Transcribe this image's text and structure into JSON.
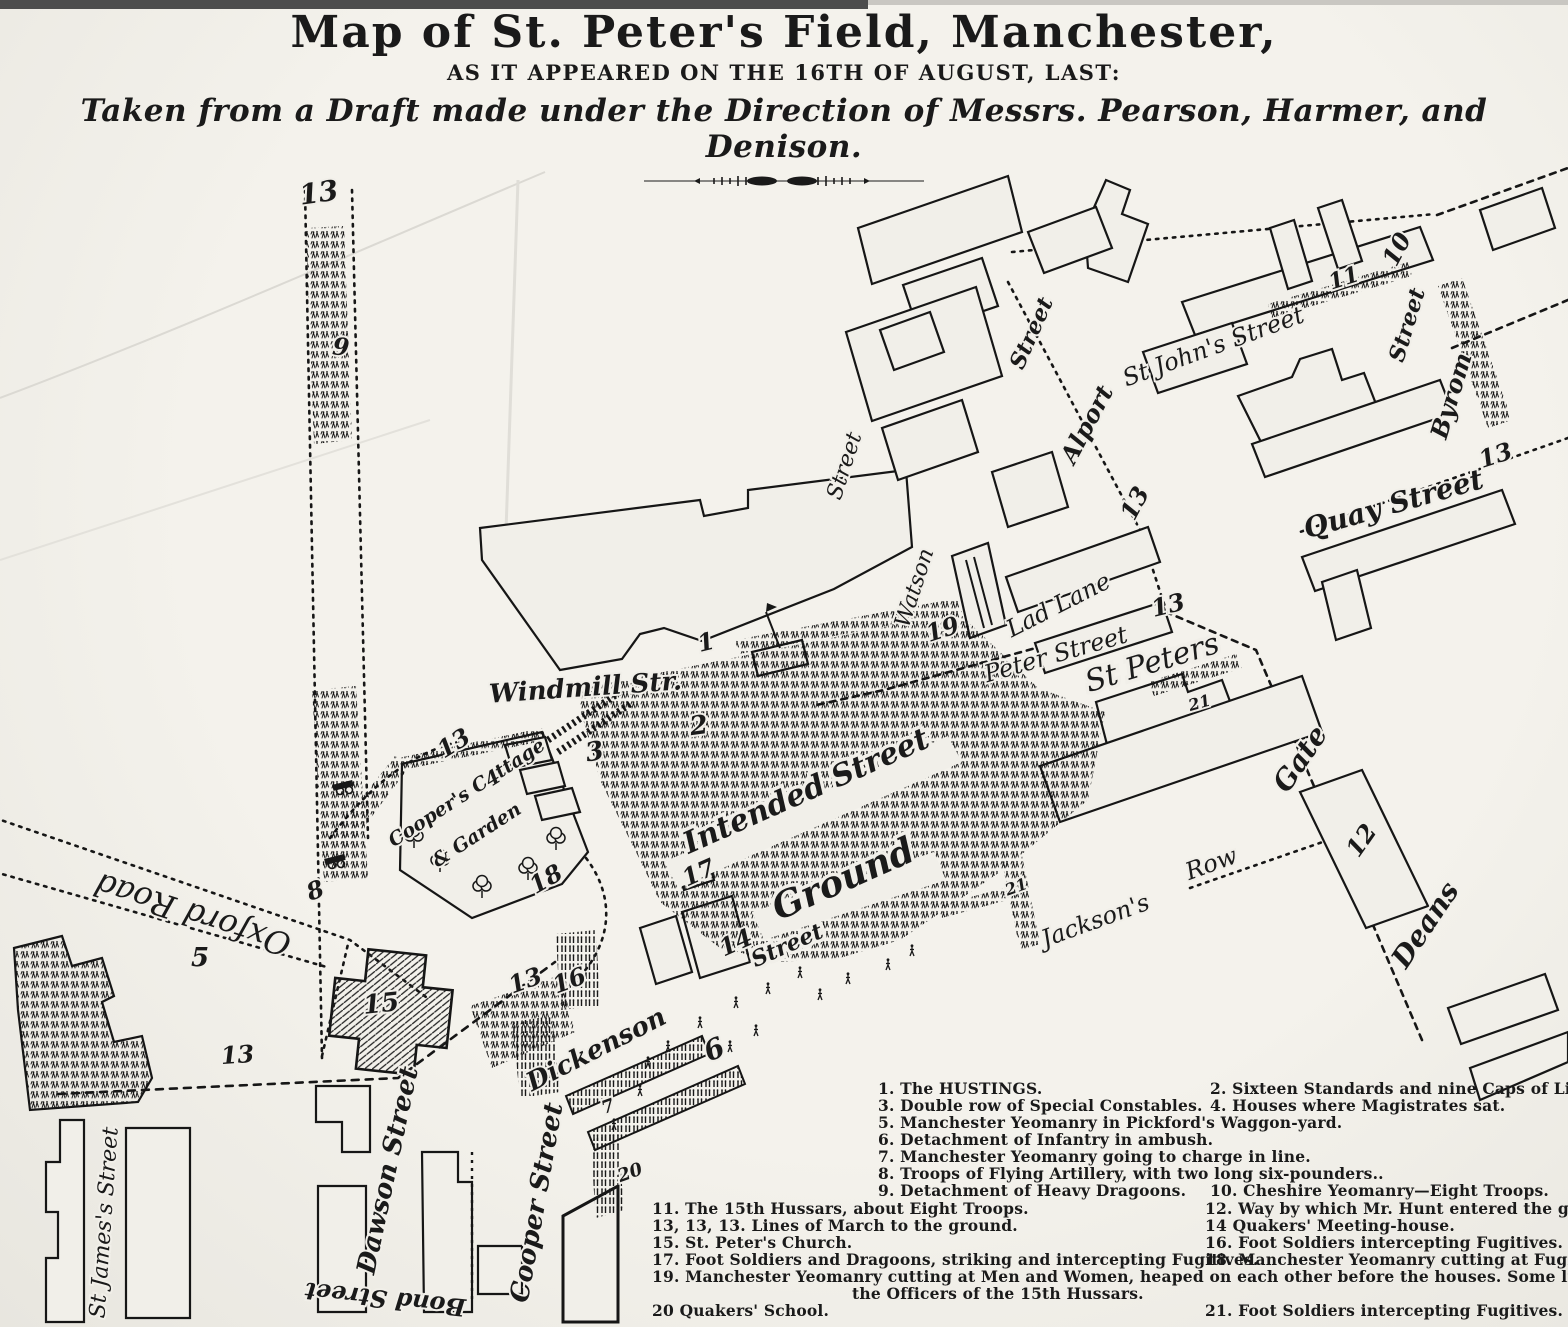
{
  "header": {
    "title": "Map of St. Peter's Field, Manchester,",
    "subtitle": "AS IT APPEARED ON THE 16TH OF AUGUST, LAST:",
    "attribution": "Taken from a Draft made under the Direction of Messrs. Pearson, Harmer, and Denison."
  },
  "map": {
    "streets": [
      {
        "text": "Windmill Str."
      },
      {
        "text": "St Peters"
      },
      {
        "text": "Intended Street"
      },
      {
        "text": "Ground"
      },
      {
        "text": "Street"
      },
      {
        "text": "Peter Street"
      },
      {
        "text": "Lad Lane"
      },
      {
        "text": "Watson"
      },
      {
        "text": "Street"
      },
      {
        "text": "Alport"
      },
      {
        "text": "Street"
      },
      {
        "text": "St John's Street"
      },
      {
        "text": "Quay Street"
      },
      {
        "text": "Byrom"
      },
      {
        "text": "Street"
      },
      {
        "text": "Deans"
      },
      {
        "text": "Gate"
      },
      {
        "text": "Jackson's"
      },
      {
        "text": "Row"
      },
      {
        "text": "Oxford Road"
      },
      {
        "text": "Dickenson"
      },
      {
        "text": "Cooper Street"
      },
      {
        "text": "Dawson Street"
      },
      {
        "text": "Bond Street"
      },
      {
        "text": "St James's Street"
      },
      {
        "text": "Cooper's Cottage"
      },
      {
        "text": "& Garden"
      }
    ],
    "numbers": [
      {
        "t": "13"
      },
      {
        "t": "9"
      },
      {
        "t": "8"
      },
      {
        "t": "5"
      },
      {
        "t": "15"
      },
      {
        "t": "13"
      },
      {
        "t": "13"
      },
      {
        "t": "4"
      },
      {
        "t": "3"
      },
      {
        "t": "18"
      },
      {
        "t": "13"
      },
      {
        "t": "16"
      },
      {
        "t": "1"
      },
      {
        "t": "2"
      },
      {
        "t": "19"
      },
      {
        "t": "17"
      },
      {
        "t": "14"
      },
      {
        "t": "6"
      },
      {
        "t": "20"
      },
      {
        "t": "7"
      },
      {
        "t": "21"
      },
      {
        "t": "21"
      },
      {
        "t": "13"
      },
      {
        "t": "13"
      },
      {
        "t": "12"
      },
      {
        "t": "11"
      },
      {
        "t": "10"
      },
      {
        "t": "13"
      }
    ]
  },
  "legend": {
    "a": [
      {
        "l": "1.  The HUSTINGS.",
        "r": "2.  Sixteen Standards and nine Caps of Liberty."
      },
      {
        "l": "3.  Double row of Special Constables.",
        "r": "4.  Houses where Magistrates sat."
      },
      {
        "l": "5.  Manchester Yeomanry in Pickford's Waggon-yard.",
        "r": ""
      },
      {
        "l": "6.  Detachment of Infantry in ambush.",
        "r": ""
      },
      {
        "l": "7.  Manchester Yeomanry going to charge in line.",
        "r": ""
      },
      {
        "l": "8.  Troops of Flying Artillery, with two long six-pounders..",
        "r": ""
      },
      {
        "l": "9.  Detachment of Heavy Dragoons.",
        "r": "10.  Cheshire Yeomanry—Eight Troops."
      }
    ],
    "b": [
      {
        "l": "11.  The 15th Hussars, about Eight Troops.",
        "r": "12.  Way by which Mr. Hunt entered the ground."
      },
      {
        "l": "13, 13, 13.  Lines of March to the ground.",
        "r": "14   Quakers' Meeting-house."
      },
      {
        "l": "15.  St. Peter's Church.",
        "r": "16.  Foot Soldiers intercepting Fugitives."
      },
      {
        "l": "17.  Foot Soldiers and Dragoons, striking and intercepting Fugitives.",
        "r": "18.  Manchester Yeomanry cutting at Fugitives."
      },
      {
        "l": "19.  Manchester Yeomanry cutting at Men and Women, heaped on each other before the houses.   Some lives were saved here",
        "r": ""
      },
      {
        "l": "the Officers of the 15th Hussars.",
        "r": ""
      },
      {
        "l": "20  Quakers' School.",
        "r": "21.  Foot Soldiers intercepting Fugitives."
      }
    ]
  }
}
